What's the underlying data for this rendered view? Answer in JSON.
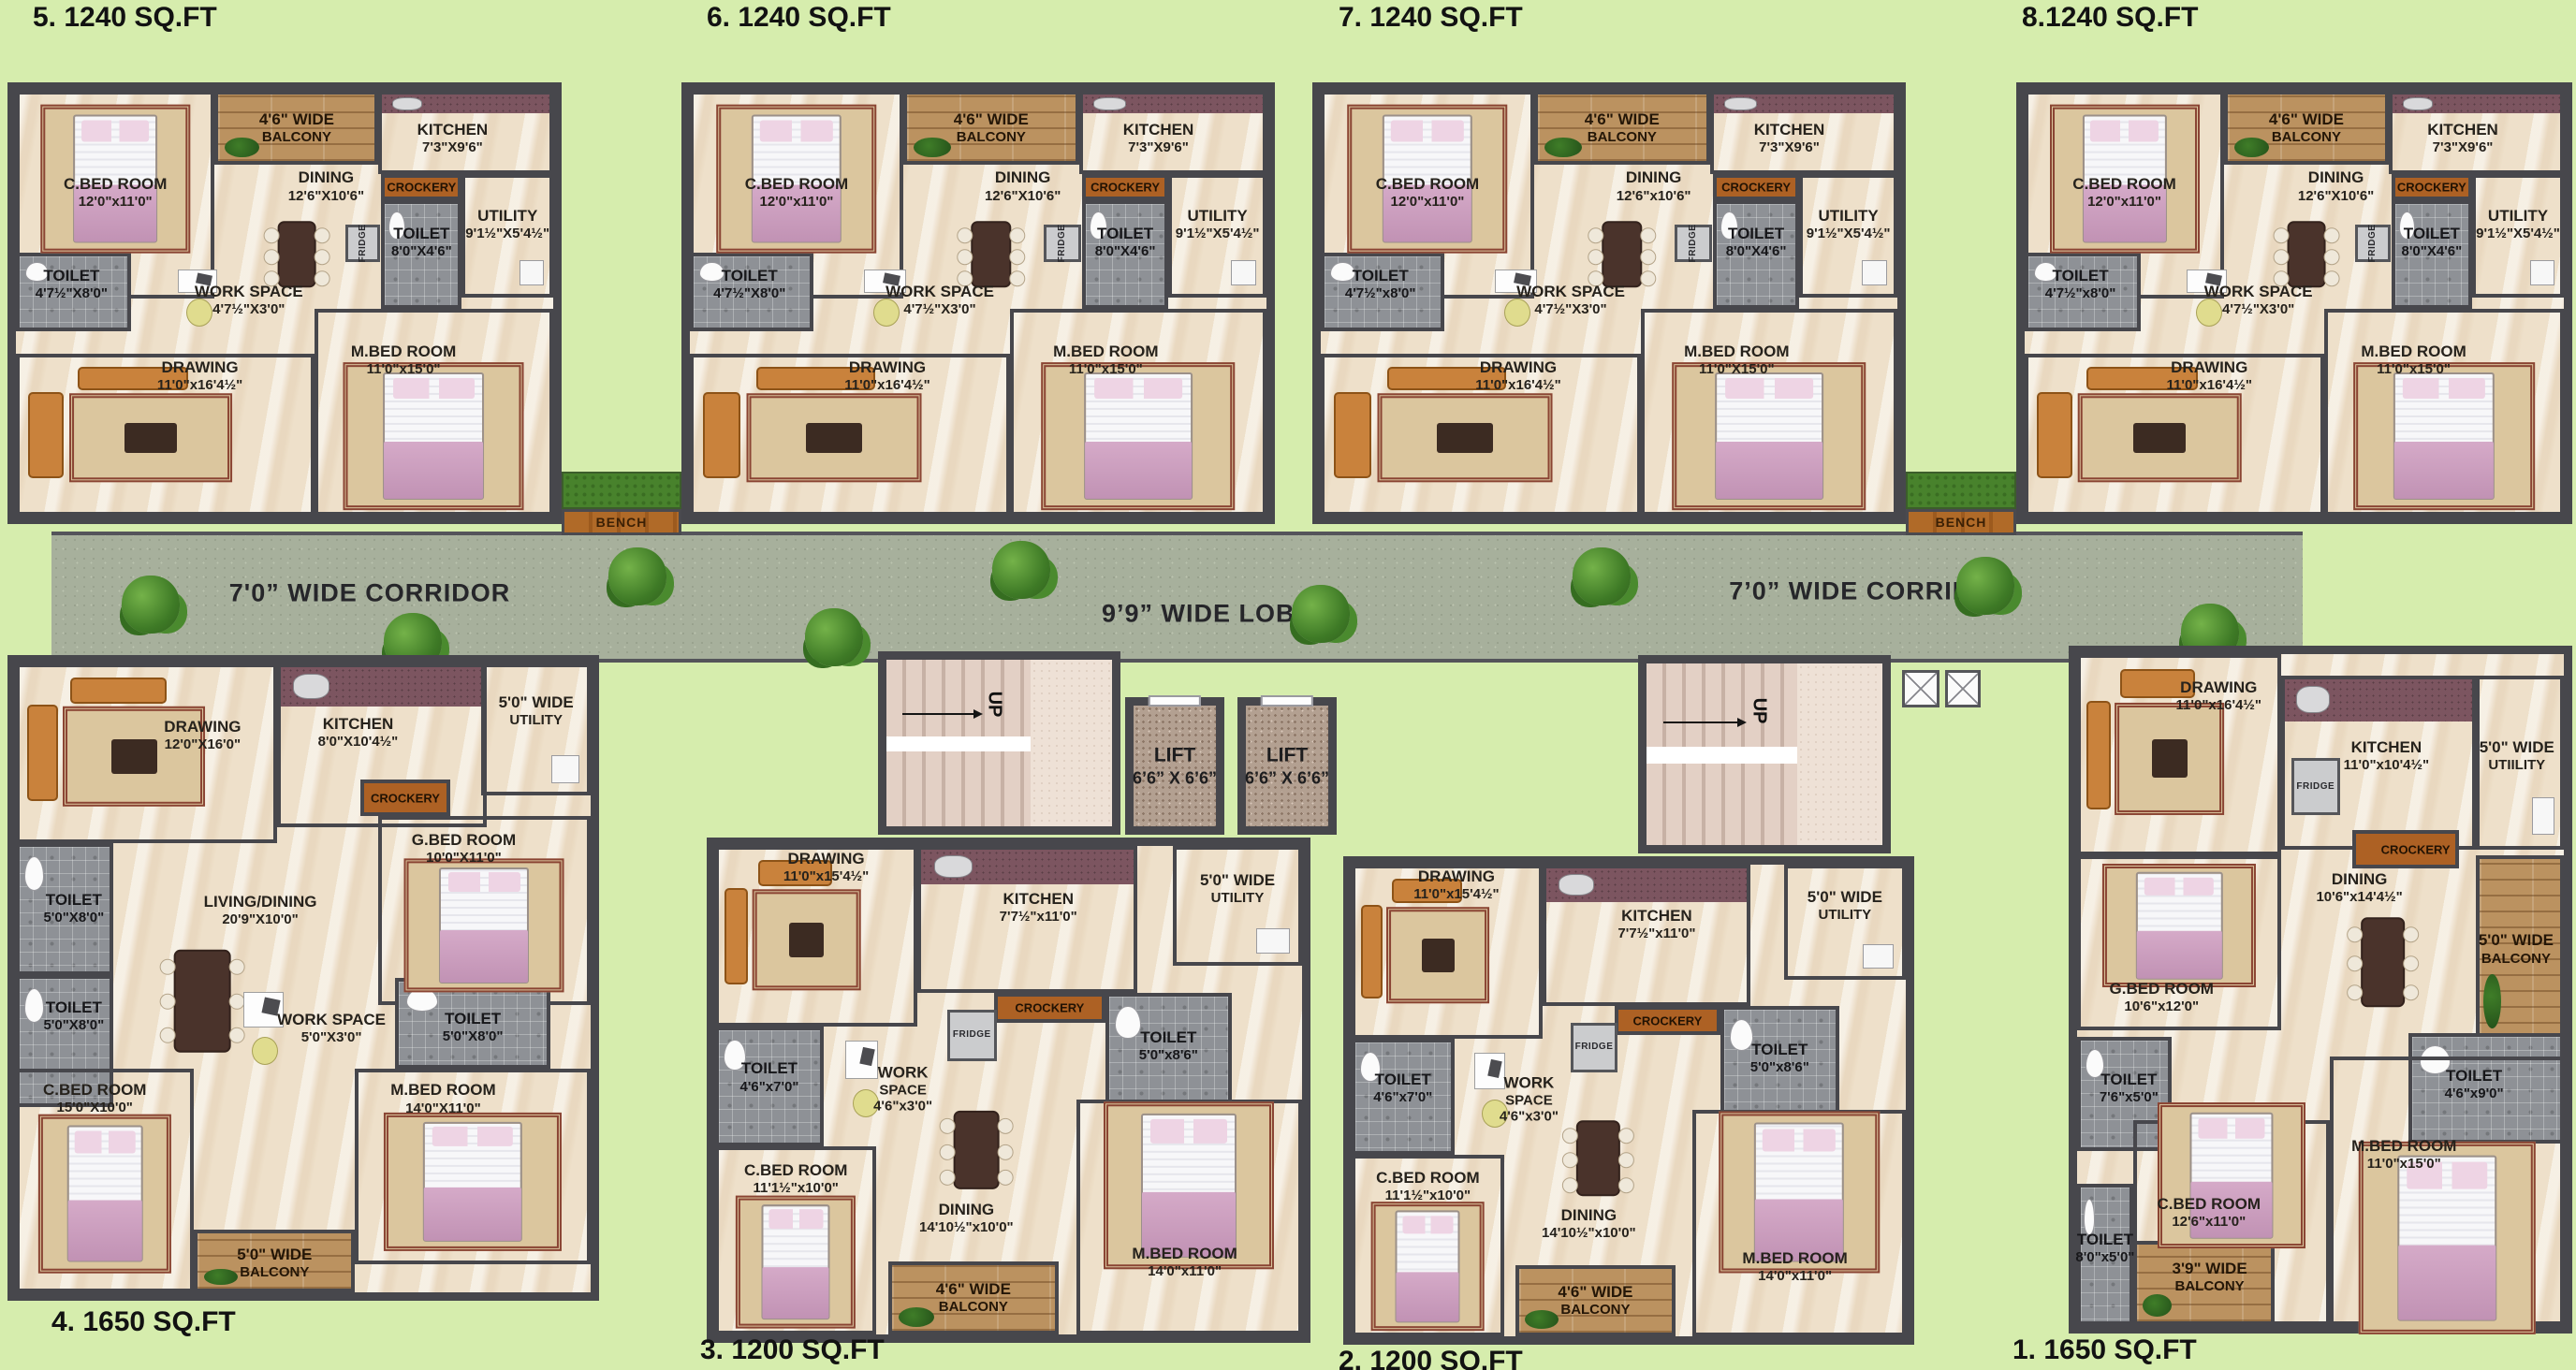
{
  "colors": {
    "background": "#d6edad",
    "wall": "#47474c",
    "floor": "#eee0ca",
    "corridor": "#a7b09c",
    "wood": "#b06a28",
    "toilet_tile": "#8e9196",
    "kitchen_counter": "#7c5560"
  },
  "corridor": {
    "left_label": "7'0” WIDE CORRIDOR",
    "lobby_label": "9’9” WIDE LOBBY",
    "right_label": "7’0” WIDE CORRIDOR"
  },
  "stairs": {
    "up_label": "UP"
  },
  "lifts": [
    {
      "lines": [
        "LIFT",
        "6’6” X 6’6”"
      ]
    },
    {
      "lines": [
        "LIFT",
        "6’6” X 6’6”"
      ]
    }
  ],
  "benches": [
    {
      "label": "BENCH"
    },
    {
      "label": "BENCH"
    }
  ],
  "units": [
    {
      "id": "unit-5",
      "title": "5. 1240 SQ.FT",
      "type": "A",
      "rooms": [
        {
          "name": "c-bed-room",
          "lines": [
            "C.BED ROOM",
            "12'0\"x11'0\""
          ]
        },
        {
          "name": "balcony",
          "lines": [
            "4'6\" WIDE",
            "BALCONY"
          ]
        },
        {
          "name": "kitchen",
          "lines": [
            "KITCHEN",
            "7'3\"X9'6\""
          ]
        },
        {
          "name": "dining",
          "lines": [
            "DINING",
            "12'6\"X10'6\""
          ]
        },
        {
          "name": "crockery",
          "lines": [
            "CROCKERY"
          ]
        },
        {
          "name": "toilet-top",
          "lines": [
            "TOILET",
            "8'0\"X4'6\""
          ]
        },
        {
          "name": "utility",
          "lines": [
            "UTILITY",
            "9'1½\"X5'4½\""
          ]
        },
        {
          "name": "fridge",
          "lines": [
            "FRIDGE"
          ]
        },
        {
          "name": "toilet-left",
          "lines": [
            "TOILET",
            "4'7½\"X8'0\""
          ]
        },
        {
          "name": "work-space",
          "lines": [
            "WORK SPACE",
            "4'7½\"X3'0\""
          ]
        },
        {
          "name": "drawing",
          "lines": [
            "DRAWING",
            "11'0\"x16'4½\""
          ]
        },
        {
          "name": "m-bed-room",
          "lines": [
            "M.BED ROOM",
            "11'0\"x15'0\""
          ]
        }
      ]
    },
    {
      "id": "unit-6",
      "title": "6. 1240 SQ.FT",
      "type": "A",
      "rooms": [
        {
          "name": "c-bed-room",
          "lines": [
            "C.BED ROOM",
            "12'0\"x11'0\""
          ]
        },
        {
          "name": "balcony",
          "lines": [
            "4'6\" WIDE",
            "BALCONY"
          ]
        },
        {
          "name": "kitchen",
          "lines": [
            "KITCHEN",
            "7'3\"X9'6\""
          ]
        },
        {
          "name": "dining",
          "lines": [
            "DINING",
            "12'6\"X10'6\""
          ]
        },
        {
          "name": "crockery",
          "lines": [
            "CROCKERY"
          ]
        },
        {
          "name": "toilet-top",
          "lines": [
            "TOILET",
            "8'0\"X4'6\""
          ]
        },
        {
          "name": "utility",
          "lines": [
            "UTILITY",
            "9'1½\"X5'4½\""
          ]
        },
        {
          "name": "fridge",
          "lines": [
            "FRIDGE"
          ]
        },
        {
          "name": "toilet-left",
          "lines": [
            "TOILET",
            "4'7½\"X8'0\""
          ]
        },
        {
          "name": "work-space",
          "lines": [
            "WORK SPACE",
            "4'7½\"X3'0\""
          ]
        },
        {
          "name": "drawing",
          "lines": [
            "DRAWING",
            "11'0\"x16'4½\""
          ]
        },
        {
          "name": "m-bed-room",
          "lines": [
            "M.BED ROOM",
            "11'0\"x15'0\""
          ]
        }
      ]
    },
    {
      "id": "unit-7",
      "title": "7. 1240 SQ.FT",
      "type": "A",
      "rooms": [
        {
          "name": "c-bed-room",
          "lines": [
            "C.BED ROOM",
            "12'0\"x11'0\""
          ]
        },
        {
          "name": "balcony",
          "lines": [
            "4'6\" WIDE",
            "BALCONY"
          ]
        },
        {
          "name": "kitchen",
          "lines": [
            "KITCHEN",
            "7'3\"X9'6\""
          ]
        },
        {
          "name": "dining",
          "lines": [
            "DINING",
            "12'6\"x10'6\""
          ]
        },
        {
          "name": "crockery",
          "lines": [
            "CROCKERY"
          ]
        },
        {
          "name": "toilet-top",
          "lines": [
            "TOILET",
            "8'0\"X4'6\""
          ]
        },
        {
          "name": "utility",
          "lines": [
            "UTILITY",
            "9'1½\"X5'4½\""
          ]
        },
        {
          "name": "fridge",
          "lines": [
            "FRIDGE"
          ]
        },
        {
          "name": "toilet-left",
          "lines": [
            "TOILET",
            "4'7½\"x8'0\""
          ]
        },
        {
          "name": "work-space",
          "lines": [
            "WORK SPACE",
            "4'7½\"X3'0\""
          ]
        },
        {
          "name": "drawing",
          "lines": [
            "DRAWING",
            "11'0\"x16'4½\""
          ]
        },
        {
          "name": "m-bed-room",
          "lines": [
            "M.BED ROOM",
            "11'0\"X15'0\""
          ]
        }
      ]
    },
    {
      "id": "unit-8",
      "title": "8.1240 SQ.FT",
      "type": "A",
      "rooms": [
        {
          "name": "c-bed-room",
          "lines": [
            "C.BED ROOM",
            "12'0\"x11'0\""
          ]
        },
        {
          "name": "balcony",
          "lines": [
            "4'6\" WIDE",
            "BALCONY"
          ]
        },
        {
          "name": "kitchen",
          "lines": [
            "KITCHEN",
            "7'3\"X9'6\""
          ]
        },
        {
          "name": "dining",
          "lines": [
            "DINING",
            "12'6\"X10'6\""
          ]
        },
        {
          "name": "crockery",
          "lines": [
            "CROCKERY"
          ]
        },
        {
          "name": "toilet-top",
          "lines": [
            "TOILET",
            "8'0\"X4'6\""
          ]
        },
        {
          "name": "utility",
          "lines": [
            "UTILITY",
            "9'1½\"X5'4½\""
          ]
        },
        {
          "name": "fridge",
          "lines": [
            "FRIDGE"
          ]
        },
        {
          "name": "toilet-left",
          "lines": [
            "TOILET",
            "4'7½\"x8'0\""
          ]
        },
        {
          "name": "work-space",
          "lines": [
            "WORK SPACE",
            "4'7½\"X3'0\""
          ]
        },
        {
          "name": "drawing",
          "lines": [
            "DRAWING",
            "11'0\"x16'4½\""
          ]
        },
        {
          "name": "m-bed-room",
          "lines": [
            "M.BED ROOM",
            "11'0\"x15'0\""
          ]
        }
      ]
    },
    {
      "id": "unit-4",
      "title": "4.  1650 SQ.FT",
      "type": "C",
      "rooms": [
        {
          "name": "drawing",
          "lines": [
            "DRAWING",
            "12'0\"X16'0\""
          ]
        },
        {
          "name": "kitchen",
          "lines": [
            "KITCHEN",
            "8'0\"X10'4½\""
          ]
        },
        {
          "name": "utility",
          "lines": [
            "5'0\" WIDE",
            "UTILITY"
          ]
        },
        {
          "name": "crockery",
          "lines": [
            "CROCKERY"
          ]
        },
        {
          "name": "g-bed-room",
          "lines": [
            "G.BED ROOM",
            "10'0\"X11'0\""
          ]
        },
        {
          "name": "living-dining",
          "lines": [
            "LIVING/DINING",
            "20'9\"X10'0\""
          ]
        },
        {
          "name": "toilet-1",
          "lines": [
            "TOILET",
            "5'0\"X8'0\""
          ]
        },
        {
          "name": "toilet-2",
          "lines": [
            "TOILET",
            "5'0\"X8'0\""
          ]
        },
        {
          "name": "work-space",
          "lines": [
            "WORK SPACE",
            "5'0\"X3'0\""
          ]
        },
        {
          "name": "toilet-3",
          "lines": [
            "TOILET",
            "5'0\"X8'0\""
          ]
        },
        {
          "name": "c-bed-room",
          "lines": [
            "C.BED ROOM",
            "15'0\"X10'0\""
          ]
        },
        {
          "name": "m-bed-room",
          "lines": [
            "M.BED ROOM",
            "14'0\"X11'0\""
          ]
        },
        {
          "name": "balcony",
          "lines": [
            "5'0\" WIDE",
            "BALCONY"
          ]
        }
      ]
    },
    {
      "id": "unit-3",
      "title": "3. 1200 SQ.FT",
      "type": "B",
      "rooms": [
        {
          "name": "drawing",
          "lines": [
            "DRAWING",
            "11'0\"x15'4½\""
          ]
        },
        {
          "name": "kitchen",
          "lines": [
            "KITCHEN",
            "7'7½\"x11'0\""
          ]
        },
        {
          "name": "utility",
          "lines": [
            "5'0\" WIDE",
            "UTILITY"
          ]
        },
        {
          "name": "crockery",
          "lines": [
            "CROCKERY"
          ]
        },
        {
          "name": "fridge",
          "lines": [
            "FRIDGE"
          ]
        },
        {
          "name": "toilet-right",
          "lines": [
            "TOILET",
            "5'0\"x8'6\""
          ]
        },
        {
          "name": "toilet-left",
          "lines": [
            "TOILET",
            "4'6\"x7'0\""
          ]
        },
        {
          "name": "work-space",
          "lines": [
            "WORK",
            "SPACE",
            "4'6\"x3'0\""
          ]
        },
        {
          "name": "c-bed-room",
          "lines": [
            "C.BED ROOM",
            "11'1½\"x10'0\""
          ]
        },
        {
          "name": "dining",
          "lines": [
            "DINING",
            "14'10½\"x10'0\""
          ]
        },
        {
          "name": "balcony",
          "lines": [
            "4'6\" WIDE",
            "BALCONY"
          ]
        },
        {
          "name": "m-bed-room",
          "lines": [
            "M.BED ROOM",
            "14'0\"x11'0\""
          ]
        }
      ]
    },
    {
      "id": "unit-2",
      "title": "2. 1200 SQ.FT",
      "type": "B",
      "rooms": [
        {
          "name": "drawing",
          "lines": [
            "DRAWING",
            "11'0\"x15'4½\""
          ]
        },
        {
          "name": "kitchen",
          "lines": [
            "KITCHEN",
            "7'7½\"x11'0\""
          ]
        },
        {
          "name": "utility",
          "lines": [
            "5'0\" WIDE",
            "UTILITY"
          ]
        },
        {
          "name": "crockery",
          "lines": [
            "CROCKERY"
          ]
        },
        {
          "name": "fridge",
          "lines": [
            "FRIDGE"
          ]
        },
        {
          "name": "toilet-right",
          "lines": [
            "TOILET",
            "5'0\"x8'6\""
          ]
        },
        {
          "name": "toilet-left",
          "lines": [
            "TOILET",
            "4'6\"x7'0\""
          ]
        },
        {
          "name": "work-space",
          "lines": [
            "WORK",
            "SPACE",
            "4'6\"x3'0\""
          ]
        },
        {
          "name": "c-bed-room",
          "lines": [
            "C.BED ROOM",
            "11'1½\"x10'0\""
          ]
        },
        {
          "name": "dining",
          "lines": [
            "DINING",
            "14'10½\"x10'0\""
          ]
        },
        {
          "name": "balcony",
          "lines": [
            "4'6\" WIDE",
            "BALCONY"
          ]
        },
        {
          "name": "m-bed-room",
          "lines": [
            "M.BED ROOM",
            "14'0\"x11'0\""
          ]
        }
      ]
    },
    {
      "id": "unit-1",
      "title": "1. 1650 SQ.FT",
      "type": "D",
      "rooms": [
        {
          "name": "drawing",
          "lines": [
            "DRAWING",
            "11'0\"x16'4½\""
          ]
        },
        {
          "name": "kitchen",
          "lines": [
            "KITCHEN",
            "11'0\"x10'4½\""
          ]
        },
        {
          "name": "utility",
          "lines": [
            "5'0\" WIDE",
            "UTIILITY"
          ]
        },
        {
          "name": "fridge",
          "lines": [
            "FRIDGE"
          ]
        },
        {
          "name": "crockery",
          "lines": [
            "CROCKERY"
          ]
        },
        {
          "name": "dining",
          "lines": [
            "DINING",
            "10'6\"x14'4½\""
          ]
        },
        {
          "name": "balcony-1",
          "lines": [
            "5'0\" WIDE",
            "BALCONY"
          ]
        },
        {
          "name": "g-bed-room",
          "lines": [
            "G.BED ROOM",
            "10'6\"x12'0\""
          ]
        },
        {
          "name": "toilet-1",
          "lines": [
            "TOILET",
            "7'6\"x5'0\""
          ]
        },
        {
          "name": "toilet-2",
          "lines": [
            "TOILET",
            "4'6\"x9'0\""
          ]
        },
        {
          "name": "m-bed-room",
          "lines": [
            "M.BED ROOM",
            "11'0\"x15'0\""
          ]
        },
        {
          "name": "c-bed-room",
          "lines": [
            "C.BED ROOM",
            "12'6\"x11'0\""
          ]
        },
        {
          "name": "toilet-3",
          "lines": [
            "TOILET",
            "8'0\"x5'0\""
          ]
        },
        {
          "name": "balcony-2",
          "lines": [
            "3'9\" WIDE",
            "BALCONY"
          ]
        }
      ]
    }
  ]
}
